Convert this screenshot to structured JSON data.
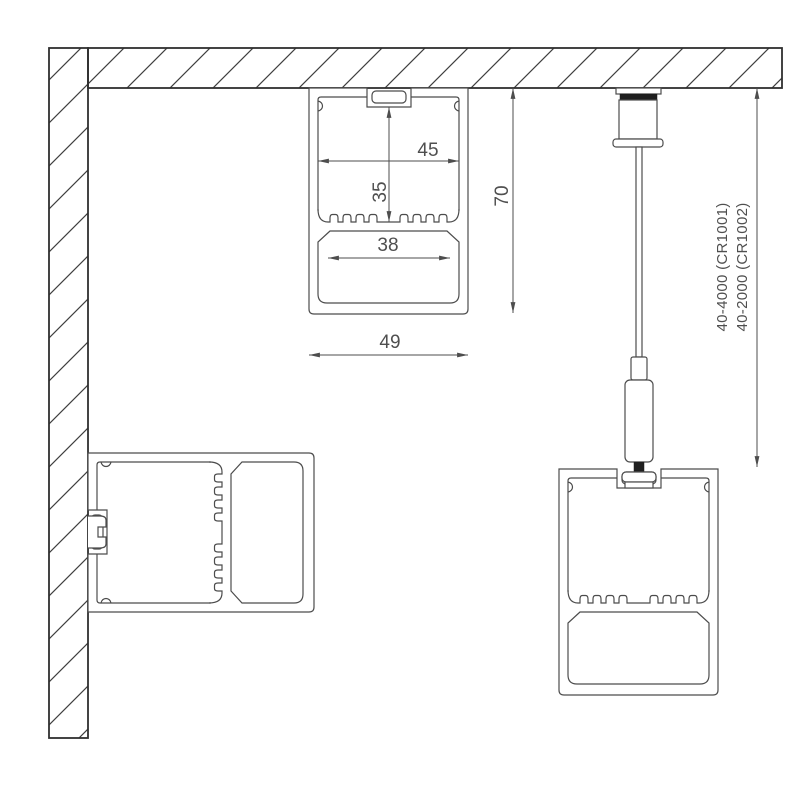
{
  "title": "LED profile mounting diagram",
  "dimensions": {
    "inner_width": "45",
    "inner_height": "35",
    "opening_width": "38",
    "outer_width": "49",
    "outer_height": "70"
  },
  "suspension_codes": {
    "line1": "40-4000 (CR1001)",
    "line2": "40-2000 (CR1002)"
  },
  "colors": {
    "ink": "#4c4c4c",
    "structure": "#2f2f2f",
    "text": "#4f4f4f",
    "background": "#ffffff"
  }
}
